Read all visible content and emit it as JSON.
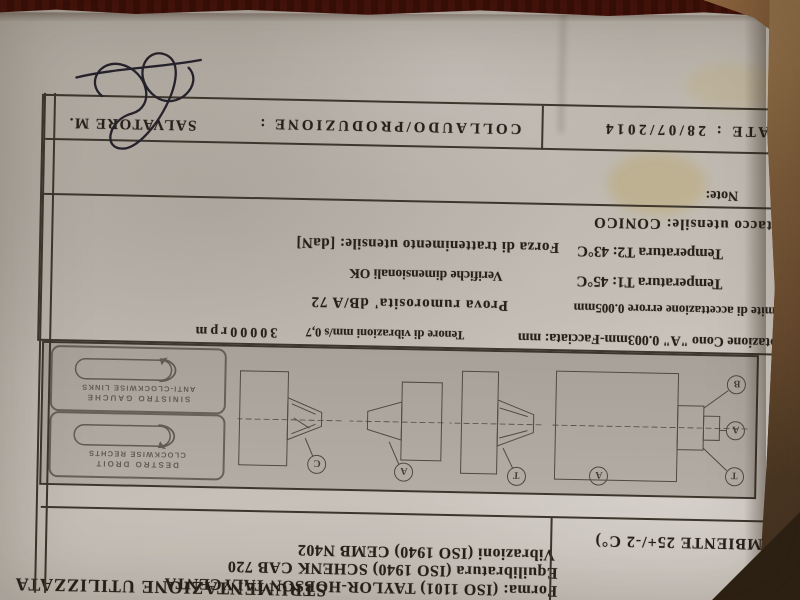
{
  "colors": {
    "paper": "#c6c0b8",
    "ink": "#262019",
    "table_wood": "#6e4f33",
    "felt_red": "#7d3b2a"
  },
  "document": {
    "title": "STRUMENTAZIONE UTILIZZATA",
    "instruments": [
      "Forma:  (ISO 1101)  TAYLOR-HOBSON TALYCENTA",
      "Equilibratura (ISO 1940)  SCHENK CAB 720",
      "Vibrazioni (ISO 1940) CEMB N402"
    ],
    "ambient": "(AMBIENTE 25+/-2 C°)",
    "stamps": {
      "clockwise": {
        "line1": "DESTRO  DROIT",
        "line2": "CLOCKWISE  RECHTS"
      },
      "anticlockwise": {
        "line1": "SINISTRO  GAUCHE",
        "line2": "ANTI-CLOCKWISE  LINKS"
      }
    },
    "balloons": [
      "T",
      "A",
      "B",
      "A",
      "T",
      "A",
      "C"
    ],
    "results": {
      "rotazione": "Rotazione Cono \"A\" 0.003mm-Facciata:  mm",
      "tenore": "Tenore di vibrazioni mm/s 0,7",
      "rpm": "30000rpm",
      "limite": "Limite di accettazione errore  0.005mm",
      "prova": "Prova rumorosita' dB/A  72",
      "temp1": "Temperatura T1:  45°C",
      "verifiche": "Verifiche dimensionali  OK",
      "temp2": "Temperatura T2:  43°C",
      "forza": "Forza di trattenimento utensile:  [daN]",
      "attacco": "Attacco utensile: CONICO",
      "note": "Note:"
    },
    "footer": {
      "date": "DATE : 28/07/2014",
      "label": "COLLAUDO/PRODUZIONE :",
      "signer": "SALVATORE M."
    }
  }
}
